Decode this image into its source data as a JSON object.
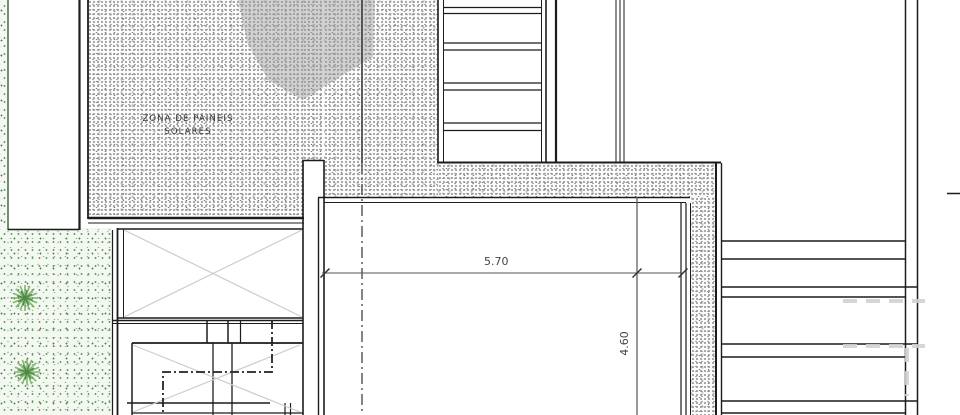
{
  "document": {
    "type": "architectural floor plan (roof / pool terrace level)",
    "language": "Portuguese"
  },
  "labels": {
    "solar_zone_line1": "ZONA DE PAINEIS",
    "solar_zone_line2": "SOLARES"
  },
  "dimensions": {
    "pool_horizontal": "5.70",
    "pool_vertical": "4.60"
  },
  "icons": {
    "plant_symbol": "plant-icon",
    "section_axis": "section-axis-line",
    "stair_break": "stair-break-line"
  },
  "colors": {
    "paper": "#ffffff",
    "wall_line": "#1c1c1c",
    "gravel_speckle": "#8f8f8f",
    "garden_background": "#f3f9f1",
    "garden_speckle": "#54864f",
    "plant_stroke": "#71a85f",
    "shadow_patch": "#9e9e9e",
    "stair_diagonal": "#cdcdcd",
    "dimension_text": "#444444",
    "watermark_dash": "#d2d2d2"
  }
}
